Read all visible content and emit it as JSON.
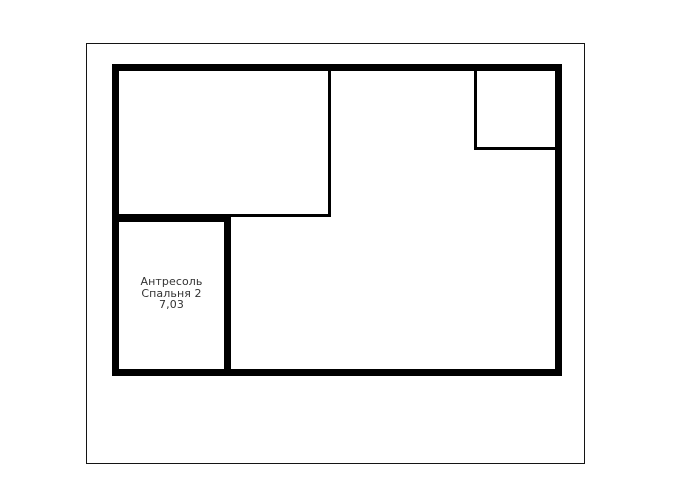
{
  "page": {
    "background_color": "#ffffff"
  },
  "floor_plan": {
    "colors": {
      "wall": "#000000",
      "thin_line": "#141414",
      "label_text": "#333333"
    },
    "labeled_room": {
      "name_line1": "Антресоль",
      "name_line2": "Спальня 2",
      "area": "7,03"
    },
    "rooms": [
      {
        "id": "upper-left-room",
        "label": ""
      },
      {
        "id": "top-right-room",
        "label": ""
      },
      {
        "id": "mezzanine-bedroom-2",
        "label": "Антресоль Спальня 2 7,03"
      },
      {
        "id": "main-open-area",
        "label": ""
      }
    ]
  }
}
